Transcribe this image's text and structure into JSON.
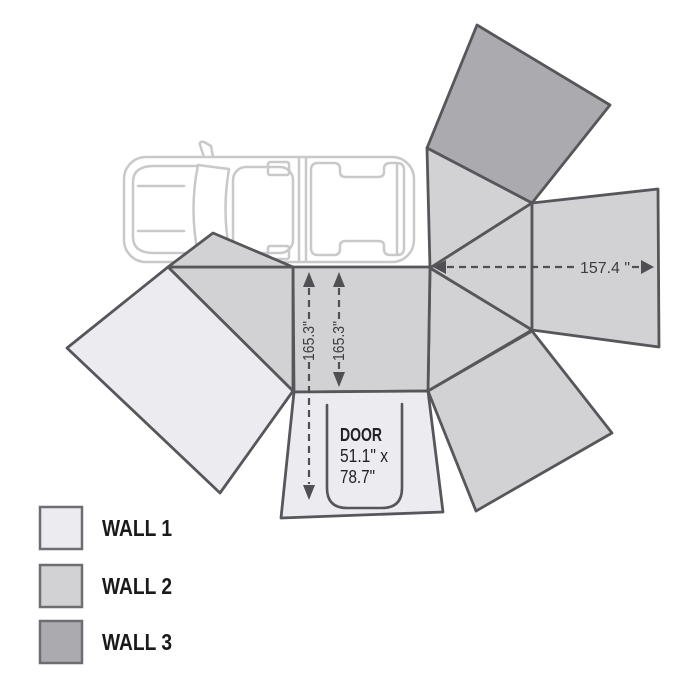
{
  "diagram": {
    "dims": {
      "total_width": "157.4 \"",
      "wall_depth_left": "165.3\"",
      "wall_depth_right": "165.3\""
    },
    "door": {
      "title": "DOOR",
      "size_line1": "51.1\" x",
      "size_line2": "78.7\""
    },
    "legend": [
      {
        "label": "WALL 1",
        "color": "#ebebf0"
      },
      {
        "label": "WALL 2",
        "color": "#d2d2d5"
      },
      {
        "label": "WALL 3",
        "color": "#ababaf"
      }
    ],
    "colors": {
      "panel_stroke": "#57575b",
      "dimension_ink": "#4f4f54",
      "door_text": "#222226",
      "legend_text": "#1a1a1a",
      "car_outline": "#c9c9cc",
      "background": "#ffffff"
    }
  }
}
